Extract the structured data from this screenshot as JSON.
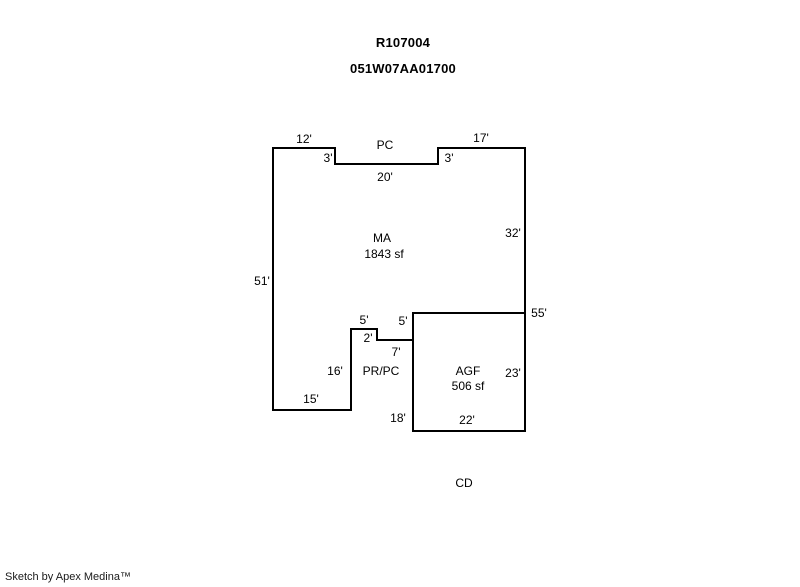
{
  "header": {
    "property_id": "R107004",
    "map_taxlot": "051W07AA01700"
  },
  "footer": {
    "credit": "Sketch by Apex Medina™"
  },
  "diagram": {
    "canvas": {
      "width": 800,
      "height": 587,
      "background": "#ffffff"
    },
    "stroke_color": "#000000",
    "stroke_width": 2,
    "areas": [
      {
        "name": "main-area-outline",
        "code": "MA",
        "area_label": "1843 sf",
        "points": [
          [
            273,
            148
          ],
          [
            335,
            148
          ],
          [
            335,
            164
          ],
          [
            438,
            164
          ],
          [
            438,
            148
          ],
          [
            525,
            148
          ],
          [
            525,
            313
          ],
          [
            413,
            313
          ],
          [
            413,
            340
          ],
          [
            377,
            340
          ],
          [
            377,
            329
          ],
          [
            351,
            329
          ],
          [
            351,
            410
          ],
          [
            273,
            410
          ]
        ]
      },
      {
        "name": "garage-outline",
        "code": "AGF",
        "area_label": "506 sf",
        "points": [
          [
            413,
            313
          ],
          [
            525,
            313
          ],
          [
            525,
            431
          ],
          [
            413,
            431
          ]
        ]
      }
    ],
    "labels": [
      {
        "name": "dim-top-left-12",
        "text": "12'",
        "x": 304,
        "y": 139
      },
      {
        "name": "room-code-pc",
        "text": "PC",
        "x": 385,
        "y": 145
      },
      {
        "name": "dim-top-right-17",
        "text": "17'",
        "x": 481,
        "y": 138
      },
      {
        "name": "dim-notch-left-3",
        "text": "3'",
        "x": 328,
        "y": 158
      },
      {
        "name": "dim-notch-right-3",
        "text": "3'",
        "x": 449,
        "y": 158
      },
      {
        "name": "dim-notch-bottom-20",
        "text": "20'",
        "x": 385,
        "y": 177
      },
      {
        "name": "room-code-ma",
        "text": "MA",
        "x": 382,
        "y": 238
      },
      {
        "name": "area-ma-sqft",
        "text": "1843 sf",
        "x": 384,
        "y": 254
      },
      {
        "name": "dim-left-51",
        "text": "51'",
        "x": 262,
        "y": 281
      },
      {
        "name": "dim-right-32",
        "text": "32'",
        "x": 513,
        "y": 233
      },
      {
        "name": "dim-right-55",
        "text": "55'",
        "x": 539,
        "y": 313
      },
      {
        "name": "dim-step-left-5",
        "text": "5'",
        "x": 364,
        "y": 320
      },
      {
        "name": "dim-step-right-5",
        "text": "5'",
        "x": 403,
        "y": 321
      },
      {
        "name": "dim-step-2",
        "text": "2'",
        "x": 368,
        "y": 338
      },
      {
        "name": "dim-step-7",
        "text": "7'",
        "x": 396,
        "y": 352
      },
      {
        "name": "dim-left-16",
        "text": "16'",
        "x": 335,
        "y": 371
      },
      {
        "name": "room-code-prpc",
        "text": "PR/PC",
        "x": 381,
        "y": 371
      },
      {
        "name": "room-code-agf",
        "text": "AGF",
        "x": 468,
        "y": 371
      },
      {
        "name": "area-agf-sqft",
        "text": "506 sf",
        "x": 468,
        "y": 386
      },
      {
        "name": "dim-agf-right-23",
        "text": "23'",
        "x": 513,
        "y": 373
      },
      {
        "name": "dim-bottom-15",
        "text": "15'",
        "x": 311,
        "y": 399
      },
      {
        "name": "dim-agf-left-18",
        "text": "18'",
        "x": 398,
        "y": 418
      },
      {
        "name": "dim-agf-bottom-22",
        "text": "22'",
        "x": 467,
        "y": 420
      },
      {
        "name": "room-code-cd",
        "text": "CD",
        "x": 464,
        "y": 483
      }
    ]
  }
}
